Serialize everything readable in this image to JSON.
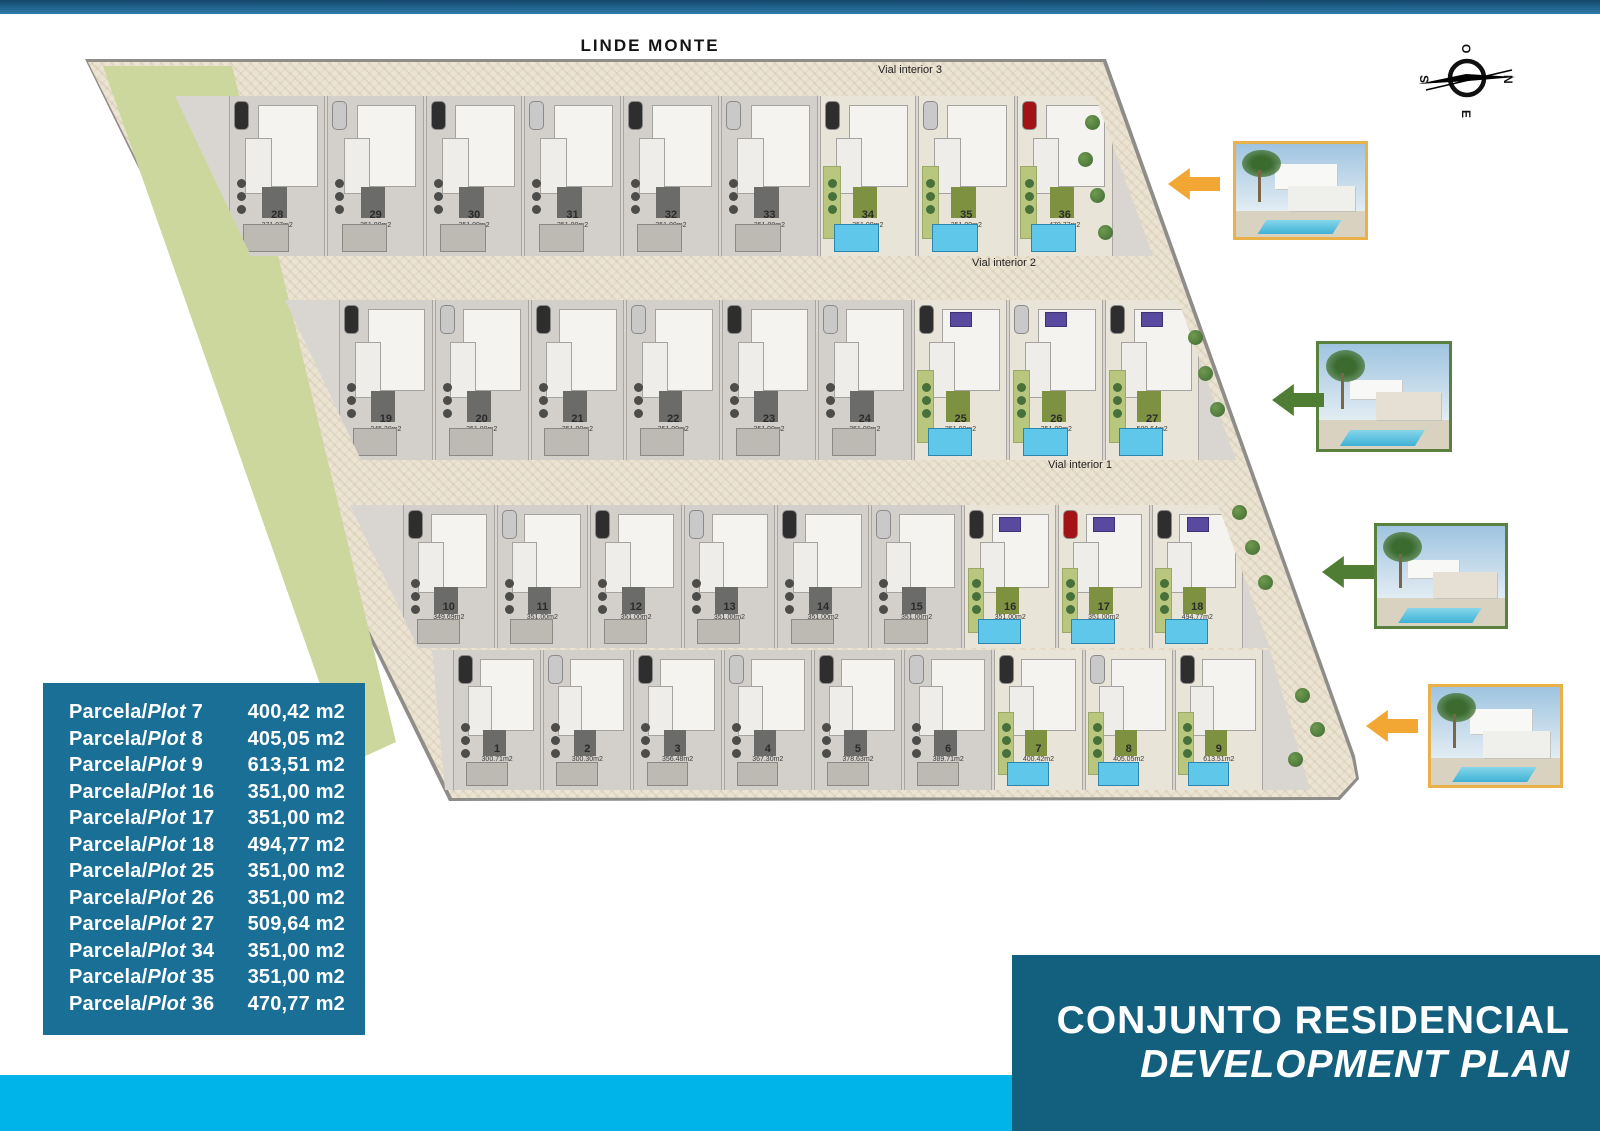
{
  "page_title": "LINDE MONTE",
  "compass": {
    "top": "O",
    "right": "N",
    "bottom": "E",
    "left": "S"
  },
  "roads": [
    {
      "id": "vial-interior-3",
      "label": "Vial interior 3"
    },
    {
      "id": "vial-interior-2",
      "label": "Vial interior 2"
    },
    {
      "id": "vial-interior-1",
      "label": "Vial interior 1"
    }
  ],
  "plan": {
    "rows": [
      {
        "id": "row-28-36",
        "plots": [
          {
            "num": "28",
            "area": "371.97m2",
            "type": "gray"
          },
          {
            "num": "29",
            "area": "351.00m2",
            "type": "gray"
          },
          {
            "num": "30",
            "area": "351.00m2",
            "type": "gray"
          },
          {
            "num": "31",
            "area": "351.00m2",
            "type": "gray"
          },
          {
            "num": "32",
            "area": "351.00m2",
            "type": "gray"
          },
          {
            "num": "33",
            "area": "351.00m2",
            "type": "gray"
          },
          {
            "num": "34",
            "area": "351.00m2",
            "type": "color"
          },
          {
            "num": "35",
            "area": "351.00m2",
            "type": "color"
          },
          {
            "num": "36",
            "area": "470.77m2",
            "type": "color",
            "car": "red"
          }
        ]
      },
      {
        "id": "row-19-27",
        "plots": [
          {
            "num": "19",
            "area": "345.38m2",
            "type": "gray"
          },
          {
            "num": "20",
            "area": "351.00m2",
            "type": "gray"
          },
          {
            "num": "21",
            "area": "351.00m2",
            "type": "gray"
          },
          {
            "num": "22",
            "area": "351.00m2",
            "type": "gray"
          },
          {
            "num": "23",
            "area": "351.00m2",
            "type": "gray"
          },
          {
            "num": "24",
            "area": "351.00m2",
            "type": "gray"
          },
          {
            "num": "25",
            "area": "351.00m2",
            "type": "color",
            "panel": true
          },
          {
            "num": "26",
            "area": "351.00m2",
            "type": "color",
            "panel": true
          },
          {
            "num": "27",
            "area": "509.64m2",
            "type": "color",
            "panel": true
          }
        ]
      },
      {
        "id": "row-10-18",
        "plots": [
          {
            "num": "10",
            "area": "349.69m2",
            "type": "gray"
          },
          {
            "num": "11",
            "area": "351.00m2",
            "type": "gray"
          },
          {
            "num": "12",
            "area": "351.00m2",
            "type": "gray"
          },
          {
            "num": "13",
            "area": "351.00m2",
            "type": "gray"
          },
          {
            "num": "14",
            "area": "351.00m2",
            "type": "gray"
          },
          {
            "num": "15",
            "area": "351.00m2",
            "type": "gray"
          },
          {
            "num": "16",
            "area": "351.00m2",
            "type": "color",
            "panel": true
          },
          {
            "num": "17",
            "area": "351.00m2",
            "type": "color",
            "panel": true,
            "car": "red"
          },
          {
            "num": "18",
            "area": "494.77m2",
            "type": "color",
            "panel": true
          }
        ]
      },
      {
        "id": "row-1-9",
        "plots": [
          {
            "num": "1",
            "area": "300.71m2",
            "type": "gray"
          },
          {
            "num": "2",
            "area": "300.30m2",
            "type": "gray"
          },
          {
            "num": "3",
            "area": "356.48m2",
            "type": "gray"
          },
          {
            "num": "4",
            "area": "367.30m2",
            "type": "gray"
          },
          {
            "num": "5",
            "area": "378.63m2",
            "type": "gray"
          },
          {
            "num": "6",
            "area": "389.71m2",
            "type": "gray"
          },
          {
            "num": "7",
            "area": "400.42m2",
            "type": "color"
          },
          {
            "num": "8",
            "area": "405.05m2",
            "type": "color"
          },
          {
            "num": "9",
            "area": "613.51m2",
            "type": "color"
          }
        ]
      }
    ]
  },
  "legend": {
    "label_prefix": "Parcela/",
    "label_word": "Plot",
    "rows": [
      {
        "plot": "7",
        "value": "400,42 m2"
      },
      {
        "plot": "8",
        "value": "405,05 m2"
      },
      {
        "plot": "9",
        "value": "613,51 m2"
      },
      {
        "plot": "16",
        "value": "351,00 m2"
      },
      {
        "plot": "17",
        "value": "351,00 m2"
      },
      {
        "plot": "18",
        "value": "494,77 m2"
      },
      {
        "plot": "25",
        "value": "351,00 m2"
      },
      {
        "plot": "26",
        "value": "351,00 m2"
      },
      {
        "plot": "27",
        "value": "509,64 m2"
      },
      {
        "plot": "34",
        "value": "351,00 m2"
      },
      {
        "plot": "35",
        "value": "351,00 m2"
      },
      {
        "plot": "36",
        "value": "470,77 m2"
      }
    ]
  },
  "banner": {
    "line1": "CONJUNTO RESIDENCIAL",
    "line2": "DEVELOPMENT PLAN"
  },
  "colors": {
    "accent_cyan": "#00b4e9",
    "legend_bg": "#1a6f97",
    "banner_bg": "#135f7e",
    "arrow_orange": "#f2a633",
    "arrow_green": "#4f7d33",
    "photo_border_yellow": "#e8b14a",
    "photo_border_green": "#59803f",
    "pool_blue": "#5ec7ea",
    "lawn_green": "#b9c77e",
    "green_strip": "#ccd79d"
  }
}
